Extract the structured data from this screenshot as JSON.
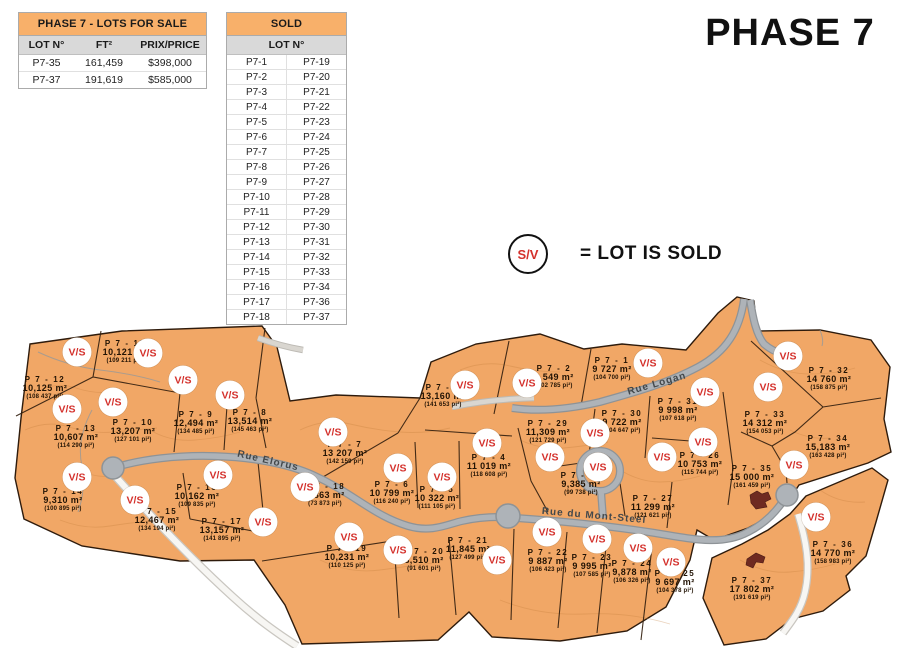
{
  "page_title": "PHASE 7",
  "colors": {
    "lot_fill": "#F1A766",
    "road_gray": "#AEB3B8",
    "badge_red": "#D4312C",
    "header_orange": "#F8B06A",
    "subheader_gray": "#D9D9D9",
    "boundary_brown": "#33200F"
  },
  "for_sale_table": {
    "title": "PHASE 7 - LOTS FOR SALE",
    "columns": [
      "LOT N°",
      "FT²",
      "PRIX/PRICE"
    ],
    "rows": [
      [
        "P7-35",
        "161,459",
        "$398,000"
      ],
      [
        "P7-37",
        "191,619",
        "$585,000"
      ]
    ]
  },
  "sold_table": {
    "title": "SOLD",
    "column_header": "LOT N°",
    "rows": [
      [
        "P7-1",
        "P7-19"
      ],
      [
        "P7-2",
        "P7-20"
      ],
      [
        "P7-3",
        "P7-21"
      ],
      [
        "P7-4",
        "P7-22"
      ],
      [
        "P7-5",
        "P7-23"
      ],
      [
        "P7-6",
        "P7-24"
      ],
      [
        "P7-7",
        "P7-25"
      ],
      [
        "P7-8",
        "P7-26"
      ],
      [
        "P7-9",
        "P7-27"
      ],
      [
        "P7-10",
        "P7-28"
      ],
      [
        "P7-11",
        "P7-29"
      ],
      [
        "P7-12",
        "P7-30"
      ],
      [
        "P7-13",
        "P7-31"
      ],
      [
        "P7-14",
        "P7-32"
      ],
      [
        "P7-15",
        "P7-33"
      ],
      [
        "P7-16",
        "P7-34"
      ],
      [
        "P7-17",
        "P7-36"
      ],
      [
        "P7-18",
        "P7-37"
      ]
    ]
  },
  "legend": {
    "badge": "S/V",
    "text": "= LOT IS SOLD"
  },
  "map": {
    "badge_label": "V/S",
    "roads": [
      {
        "name": "Rue Elorus",
        "x": 268,
        "y": 461,
        "angle": 13
      },
      {
        "name": "Rue du Mont-Steel",
        "x": 594,
        "y": 516,
        "angle": 5
      },
      {
        "name": "Rue Logan",
        "x": 657,
        "y": 384,
        "angle": -16
      }
    ],
    "lots": [
      {
        "name": "P 7 - 1",
        "m2": "9 727 m²",
        "pi2": "(104 700 pi²)",
        "sold": true,
        "x": 612,
        "y": 369,
        "bx": 648,
        "by": 363
      },
      {
        "name": "P 7 - 2",
        "m2": "9 549 m²",
        "pi2": "(102 785 pi²)",
        "sold": true,
        "x": 554,
        "y": 377,
        "bx": 527,
        "by": 383
      },
      {
        "name": "P 7 - 3",
        "m2": "13,160 m²",
        "pi2": "(141 653 pi²)",
        "sold": true,
        "x": 443,
        "y": 396,
        "bx": 465,
        "by": 385
      },
      {
        "name": "P 7 - 4",
        "m2": "11 019 m²",
        "pi2": "(118 608 pi²)",
        "sold": true,
        "x": 489,
        "y": 466,
        "bx": 487,
        "by": 443
      },
      {
        "name": "P 7 - 5",
        "m2": "10 322 m²",
        "pi2": "(111 105 pi²)",
        "sold": true,
        "x": 437,
        "y": 498,
        "bx": 442,
        "by": 477
      },
      {
        "name": "P 7 - 6",
        "m2": "10 799 m²",
        "pi2": "(116 240 pi²)",
        "sold": true,
        "x": 392,
        "y": 493,
        "bx": 398,
        "by": 468
      },
      {
        "name": "P 7 - 7",
        "m2": "13 207 m²",
        "pi2": "(142 159 pi²)",
        "sold": true,
        "x": 345,
        "y": 453,
        "bx": 333,
        "by": 432
      },
      {
        "name": "P 7 - 8",
        "m2": "13,514 m²",
        "pi2": "(145 463 pi²)",
        "sold": true,
        "x": 250,
        "y": 421,
        "bx": 230,
        "by": 395
      },
      {
        "name": "P 7 - 9",
        "m2": "12,494 m²",
        "pi2": "(134 485 pi²)",
        "sold": true,
        "x": 196,
        "y": 423,
        "bx": 183,
        "by": 380
      },
      {
        "name": "P 7 - 10",
        "m2": "13,207 m²",
        "pi2": "(127 101 pi²)",
        "sold": true,
        "x": 133,
        "y": 431,
        "bx": 113,
        "by": 402
      },
      {
        "name": "P 7 - 11",
        "m2": "10,121 m²",
        "pi2": "(109 211 pi²)",
        "sold": true,
        "x": 125,
        "y": 352,
        "bx": 148,
        "by": 353
      },
      {
        "name": "P 7 - 12",
        "m2": "10,125 m²",
        "pi2": "(108 437 pi²)",
        "sold": true,
        "x": 45,
        "y": 388,
        "bx": 77,
        "by": 352
      },
      {
        "name": "P 7 - 13",
        "m2": "10,607 m²",
        "pi2": "(114 290 pi²)",
        "sold": true,
        "x": 76,
        "y": 437,
        "bx": 67,
        "by": 409
      },
      {
        "name": "P 7 - 14",
        "m2": "9,310 m²",
        "pi2": "(100 895 pi²)",
        "sold": true,
        "x": 63,
        "y": 500,
        "bx": 77,
        "by": 477
      },
      {
        "name": "P 7 - 15",
        "m2": "12,467 m²",
        "pi2": "(134 194 pi²)",
        "sold": true,
        "x": 157,
        "y": 520,
        "bx": 135,
        "by": 500
      },
      {
        "name": "P 7 - 16",
        "m2": "10,162 m²",
        "pi2": "(109 835 pi²)",
        "sold": true,
        "x": 197,
        "y": 496,
        "bx": 218,
        "by": 475
      },
      {
        "name": "P 7 - 17",
        "m2": "13,157 m²",
        "pi2": "(141 895 pi²)",
        "sold": true,
        "x": 222,
        "y": 530,
        "bx": 263,
        "by": 522
      },
      {
        "name": "P 7 - 18",
        "m2": "6,863 m²",
        "pi2": "(73 873 pi²)",
        "sold": true,
        "x": 325,
        "y": 495,
        "bx": 305,
        "by": 487
      },
      {
        "name": "P 7 - 19",
        "m2": "10,231 m²",
        "pi2": "(110 125 pi²)",
        "sold": true,
        "x": 347,
        "y": 557,
        "bx": 349,
        "by": 537
      },
      {
        "name": "P 7 - 20",
        "m2": "8,510 m²",
        "pi2": "(91 601 pi²)",
        "sold": true,
        "x": 424,
        "y": 560,
        "bx": 398,
        "by": 550
      },
      {
        "name": "P 7 - 21",
        "m2": "11,845 m²",
        "pi2": "(127 499 pi²)",
        "sold": true,
        "x": 468,
        "y": 549,
        "bx": 497,
        "by": 560
      },
      {
        "name": "P 7 - 22",
        "m2": "9 887 m²",
        "pi2": "(106 423 pi²)",
        "sold": true,
        "x": 548,
        "y": 561,
        "bx": 547,
        "by": 532
      },
      {
        "name": "P 7 - 23",
        "m2": "9 995 m²",
        "pi2": "(107 585 pi²)",
        "sold": true,
        "x": 592,
        "y": 566,
        "bx": 597,
        "by": 539
      },
      {
        "name": "P 7 - 24",
        "m2": "9,878 m²",
        "pi2": "(106 326 pi²)",
        "sold": true,
        "x": 632,
        "y": 572,
        "bx": 638,
        "by": 548
      },
      {
        "name": "P 7 - 25",
        "m2": "9 697 m²",
        "pi2": "(104 378 pi²)",
        "sold": true,
        "x": 675,
        "y": 582,
        "bx": 671,
        "by": 562
      },
      {
        "name": "P 7 - 26",
        "m2": "10 753 m²",
        "pi2": "(115 744 pi²)",
        "sold": true,
        "x": 700,
        "y": 464,
        "bx": 703,
        "by": 442
      },
      {
        "name": "P 7 - 27",
        "m2": "11 299 m²",
        "pi2": "(121 621 pi²)",
        "sold": true,
        "x": 653,
        "y": 507,
        "bx": 662,
        "by": 457
      },
      {
        "name": "P 7 - 28",
        "m2": "9,385 m²",
        "pi2": "(99 738 pi²)",
        "sold": true,
        "x": 581,
        "y": 484,
        "bx": 598,
        "by": 467
      },
      {
        "name": "P 7 - 29",
        "m2": "11,309 m²",
        "pi2": "(121 729 pi²)",
        "sold": true,
        "x": 548,
        "y": 432,
        "bx": 550,
        "by": 457
      },
      {
        "name": "P 7 - 30",
        "m2": "9 722 m²",
        "pi2": "(104 647 pi²)",
        "sold": true,
        "x": 622,
        "y": 422,
        "bx": 595,
        "by": 433
      },
      {
        "name": "P 7 - 31",
        "m2": "9 998 m²",
        "pi2": "(107 618 pi²)",
        "sold": true,
        "x": 678,
        "y": 410,
        "bx": 705,
        "by": 392
      },
      {
        "name": "P 7 - 32",
        "m2": "14 760 m²",
        "pi2": "(158 875 pi²)",
        "sold": true,
        "x": 829,
        "y": 379,
        "bx": 788,
        "by": 356
      },
      {
        "name": "P 7 - 33",
        "m2": "14 312 m²",
        "pi2": "(154 053 pi²)",
        "sold": true,
        "x": 765,
        "y": 423,
        "bx": 768,
        "by": 387
      },
      {
        "name": "P 7 - 34",
        "m2": "15,183 m²",
        "pi2": "(163 428 pi²)",
        "sold": true,
        "x": 828,
        "y": 447,
        "bx": 794,
        "by": 465
      },
      {
        "name": "P 7 - 35",
        "m2": "15 000 m²",
        "pi2": "(161 459 pi²)",
        "sold": false,
        "x": 752,
        "y": 477
      },
      {
        "name": "P 7 - 36",
        "m2": "14 770 m²",
        "pi2": "(158 983 pi²)",
        "sold": true,
        "x": 833,
        "y": 553,
        "bx": 816,
        "by": 517
      },
      {
        "name": "P 7 - 37",
        "m2": "17 802 m²",
        "pi2": "(191 619 pi²)",
        "sold": false,
        "x": 752,
        "y": 589
      }
    ]
  }
}
